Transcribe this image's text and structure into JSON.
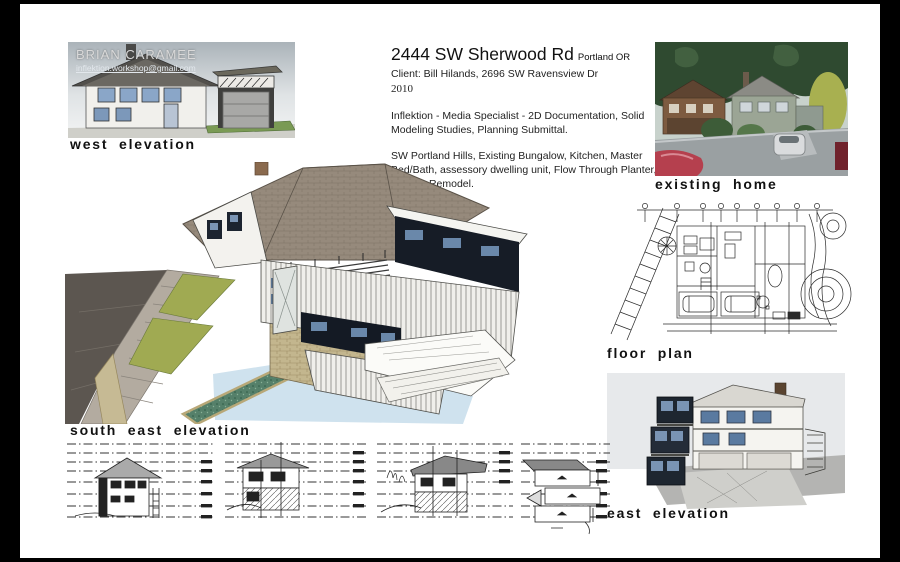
{
  "board": {
    "west_elevation": {
      "overlay_name": "BRIAN CARAMEE",
      "overlay_email": "inflektion.workshop@gmail.com",
      "label": "west elevation"
    },
    "title_block": {
      "address": "2444 SW Sherwood Rd",
      "city": "Portland OR",
      "client": "Client: Bill Hilands, 2696 SW Ravensview Dr",
      "year": "2010",
      "services": "Inflektion - Media Specialist - 2D Documentation, Solid Modeling Studies, Planning Submittal.",
      "scope": "SW Portland Hills, Existing Bungalow, Kitchen, Master Bed/Bath, assessory dwelling unit, Flow Through Planter, Garage Remodel."
    },
    "existing_home": {
      "label": "existing home"
    },
    "floor_plan": {
      "label": "floor plan"
    },
    "south_east_elevation": {
      "label": "south east elevation"
    },
    "east_elevation": {
      "label": "east elevation"
    },
    "colors": {
      "paper": "#ffffff",
      "frame": "#000000",
      "roof_brown": "#968a7c",
      "window_blue": "#7a94b4",
      "planter_green": "#55806a",
      "lawn_olive": "#a0aa52",
      "ground_blue": "#cfe2ee"
    }
  }
}
